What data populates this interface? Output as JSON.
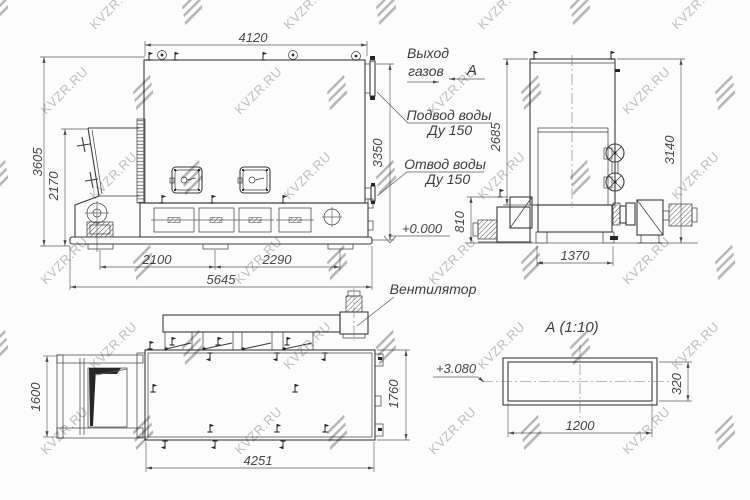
{
  "watermark": {
    "text": "KVZR.RU"
  },
  "colors": {
    "line": "#3b3b3b",
    "dim_text": "#474747",
    "watermark": "#c2c2c2",
    "background": "#fcfcfc"
  },
  "front_view": {
    "dim_width_top": "4120",
    "dim_height_total": "3605",
    "dim_height_hopper": "2170",
    "dim_height_right": "3350",
    "dim_foot_left": "2100",
    "dim_foot_right": "2290",
    "dim_width_overall": "5645",
    "level_zero": "+0.000",
    "label_gas_out_1": "Выход",
    "label_gas_out_2": "газов",
    "section_arrow_label": "А",
    "label_water_in_1": "Подвод воды",
    "label_water_in_2": "Ду 150",
    "label_water_out_1": "Отвод воды",
    "label_water_out_2": "Ду 150"
  },
  "side_view": {
    "dim_height_left": "2685",
    "dim_height_right": "3140",
    "dim_base_height": "810",
    "dim_width_bottom": "1370"
  },
  "plan_view": {
    "dim_depth_left": "1600",
    "dim_depth_right": "1760",
    "dim_width_bottom": "4251",
    "label_fan": "Вентилятор"
  },
  "section_view": {
    "title": "А (1:10)",
    "dim_width": "1200",
    "dim_height": "320",
    "level_mark": "+3.080"
  }
}
